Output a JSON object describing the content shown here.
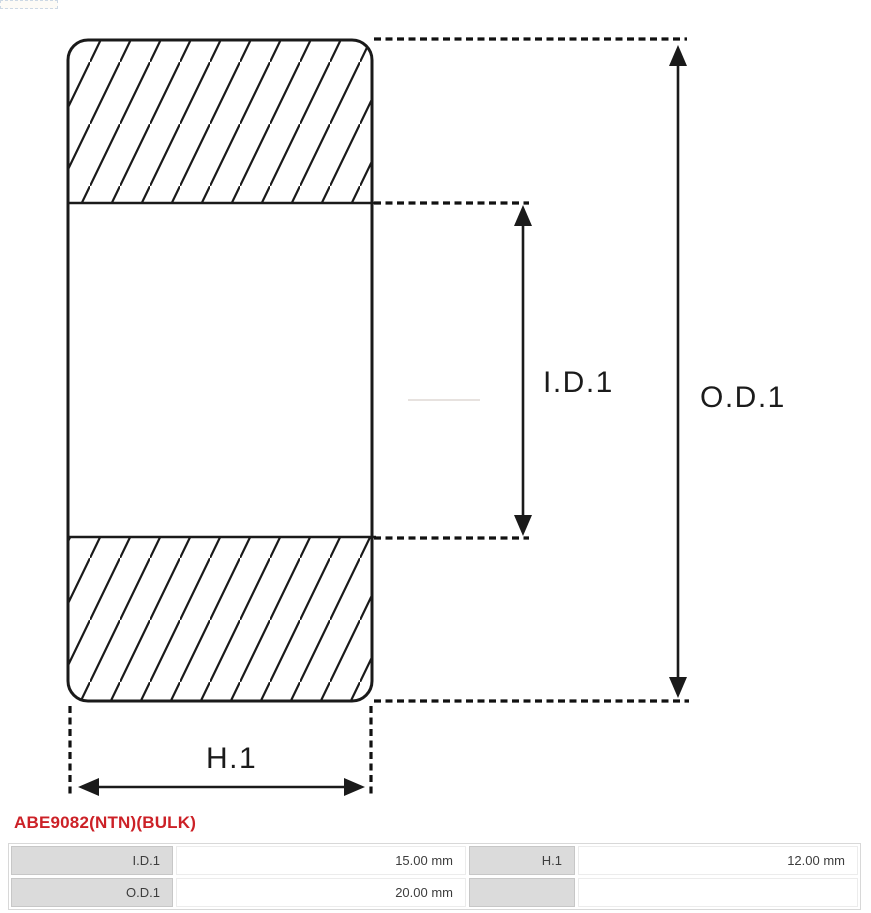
{
  "diagram": {
    "labels": {
      "inner_diameter": "I.D.1",
      "outer_diameter": "O.D.1",
      "height": "H.1"
    },
    "line_color": "#1a1a1a"
  },
  "product": {
    "code": "ABE9082(NTN)(BULK)",
    "code_color": "#cc2127"
  },
  "specs": {
    "rows": [
      {
        "cells": [
          {
            "label": "I.D.1",
            "value": "15.00 mm"
          },
          {
            "label": "H.1",
            "value": "12.00 mm"
          }
        ]
      },
      {
        "cells": [
          {
            "label": "O.D.1",
            "value": "20.00 mm"
          },
          {
            "label": "",
            "value": ""
          }
        ]
      }
    ]
  }
}
